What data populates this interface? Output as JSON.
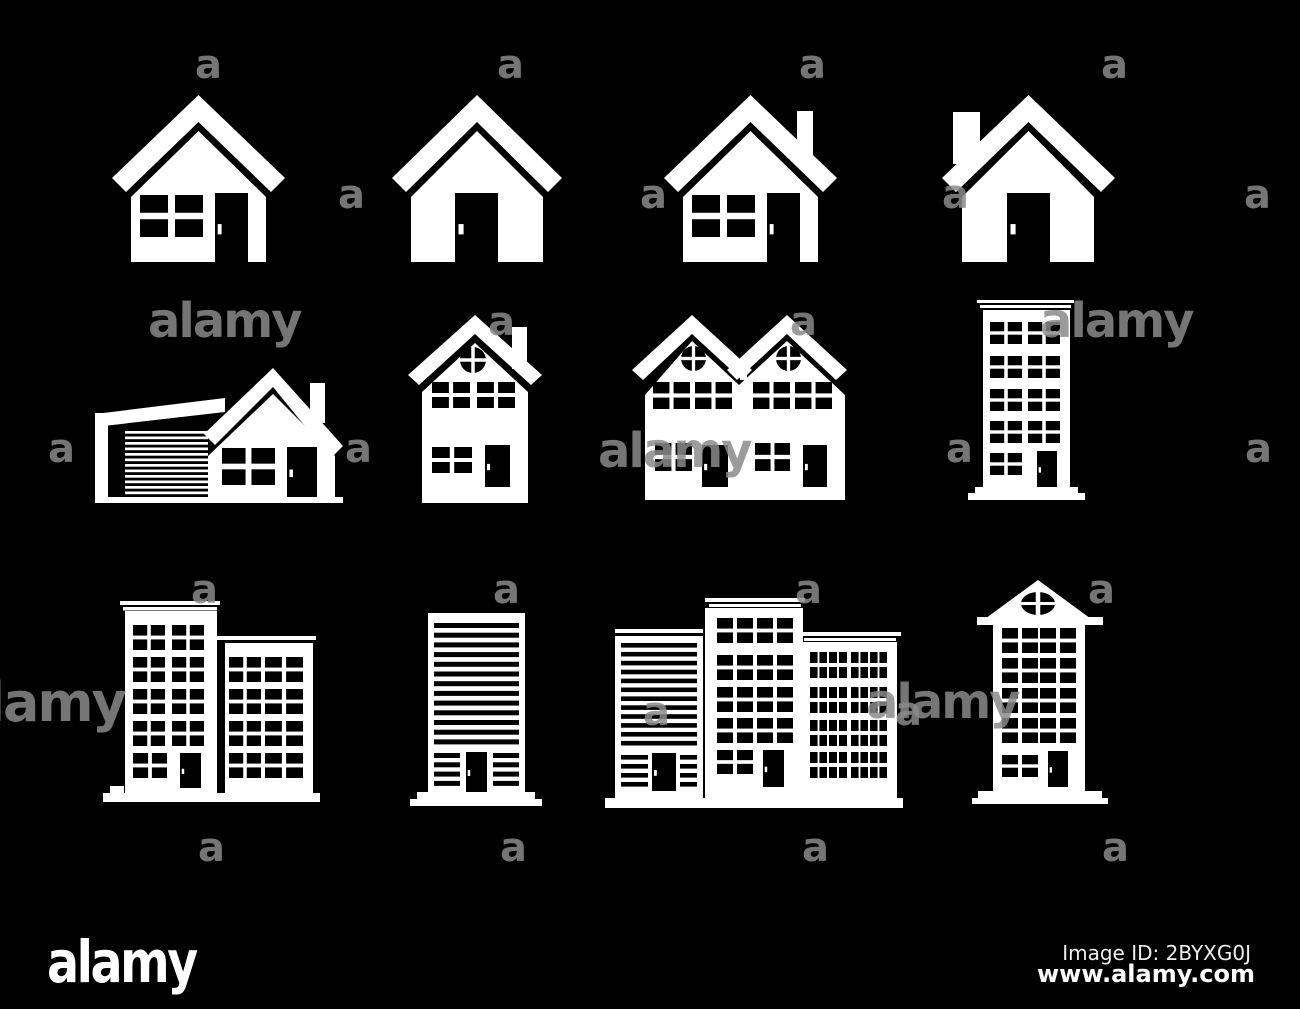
{
  "page": {
    "background_color": "#000000",
    "icon_color": "#ffffff",
    "description": "Set of white house and building silhouette icons on black background",
    "grid": {
      "rows": 3,
      "columns": 4
    }
  },
  "watermark": {
    "word": "alamy",
    "letter": "a",
    "color": "#8a8a8a"
  },
  "footer": {
    "logo_text": "alamy",
    "image_id": "Image ID: 2BYXG0J",
    "website": "www.alamy.com"
  },
  "icons": [
    {
      "label": "Single-storey house with window and door"
    },
    {
      "label": "House with open doorway"
    },
    {
      "label": "House with chimney, window and door"
    },
    {
      "label": "House with chimney and doorway"
    },
    {
      "label": "House with garage"
    },
    {
      "label": "Two-storey house with round gable window"
    },
    {
      "label": "Semi-detached duplex house"
    },
    {
      "label": "Multi-storey apartment tower"
    },
    {
      "label": "Office building with two wings"
    },
    {
      "label": "High-rise tower with window bands"
    },
    {
      "label": "Building complex of three blocks"
    },
    {
      "label": "Tower house with gabled roof"
    }
  ]
}
